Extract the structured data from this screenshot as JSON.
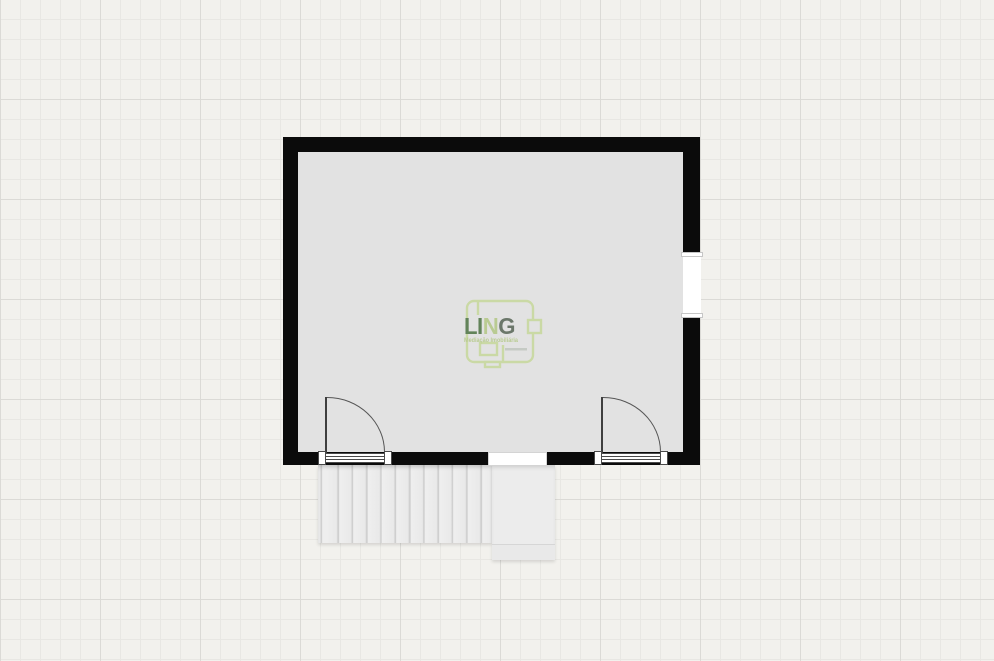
{
  "canvas": {
    "background_color": "#f2f1ed",
    "grid_minor_px": 20,
    "grid_major_px": 100
  },
  "floorplan": {
    "wall_color": "#0b0b0b",
    "room_fill_color": "#e2e2e2",
    "feature_names": [
      "room",
      "window",
      "door-left",
      "door-right",
      "wall-opening",
      "staircase",
      "landing"
    ]
  },
  "logo": {
    "text_li": "LI",
    "text_n": "N",
    "text_g": "G",
    "subtitle": "Mediação Imobiliária",
    "color_dark_green": "#587c4e",
    "color_light_green": "#b6ca8c",
    "color_gray_green": "#616e60",
    "color_outline_green": "#c9d9a0"
  }
}
